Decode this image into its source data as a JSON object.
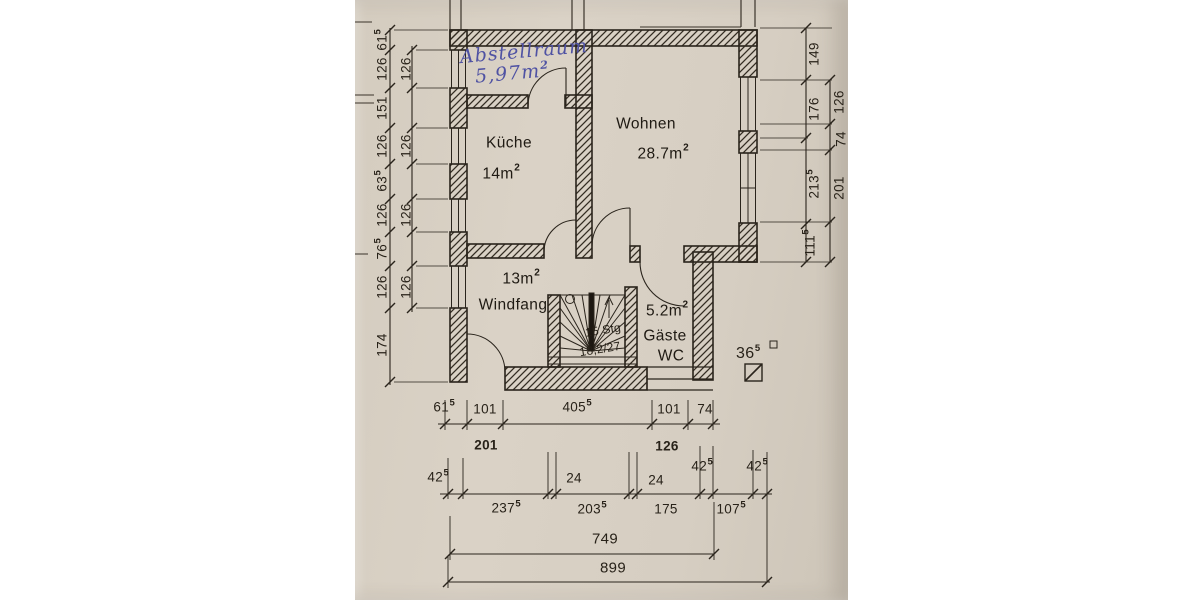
{
  "page": {
    "background": "#ffffff",
    "paper_color": "#d7cfc3",
    "ink_color": "#2a241c",
    "handwriting_color": "#4f52a3"
  },
  "rooms": {
    "abstellraum": {
      "name": "Abstellraum",
      "area": "5,97m",
      "area_sup": "2"
    },
    "kueche": {
      "name": "Küche",
      "area": "14m",
      "area_sup": "2"
    },
    "wohnen": {
      "name": "Wohnen",
      "area": "28.7m",
      "area_sup": "2"
    },
    "windfang": {
      "name": "Windfang",
      "area": "13m",
      "area_sup": "2"
    },
    "gaeste_wc": {
      "name_line1": "Gäste",
      "name_line2": "WC",
      "area": "5.2m",
      "area_sup": "2"
    }
  },
  "stair": {
    "line1": "15 Stg",
    "line2": "18,2/27"
  },
  "annotation": {
    "value": "36",
    "sup": "5"
  },
  "dims": {
    "left_outer": [
      {
        "v": "61",
        "s": "5"
      },
      {
        "v": "126"
      },
      {
        "v": "151"
      },
      {
        "v": "126"
      },
      {
        "v": "63",
        "s": "5"
      },
      {
        "v": "126"
      },
      {
        "v": "76",
        "s": "5"
      },
      {
        "v": "126"
      },
      {
        "v": "174"
      }
    ],
    "left_inner": [
      {
        "v": "126"
      },
      {
        "v": "126"
      },
      {
        "v": "126"
      },
      {
        "v": "126"
      }
    ],
    "right_inner": [
      {
        "v": "149"
      },
      {
        "v": "176"
      },
      {
        "v": "213",
        "s": "5"
      },
      {
        "v": "111",
        "s": "5"
      }
    ],
    "right_outer": [
      {
        "v": "126"
      },
      {
        "v": "74"
      },
      {
        "v": "201"
      }
    ],
    "bottom_row1": [
      {
        "v": "61",
        "s": "5"
      },
      {
        "v": "101"
      },
      {
        "v": "405",
        "s": "5"
      },
      {
        "v": "101"
      },
      {
        "v": "74"
      }
    ],
    "bottom_row1_totals": [
      {
        "v": "201"
      },
      {
        "v": "126"
      }
    ],
    "bottom_row2": [
      {
        "v": "42",
        "s": "5"
      },
      {
        "v": "237",
        "s": "5"
      },
      {
        "v": "24"
      },
      {
        "v": "203",
        "s": "5"
      },
      {
        "v": "24"
      },
      {
        "v": "175"
      },
      {
        "v": "42",
        "s": "5"
      },
      {
        "v": "107",
        "s": "5"
      },
      {
        "v": "42",
        "s": "5"
      }
    ],
    "total_inner": {
      "v": "749"
    },
    "total_outer": {
      "v": "899"
    }
  }
}
